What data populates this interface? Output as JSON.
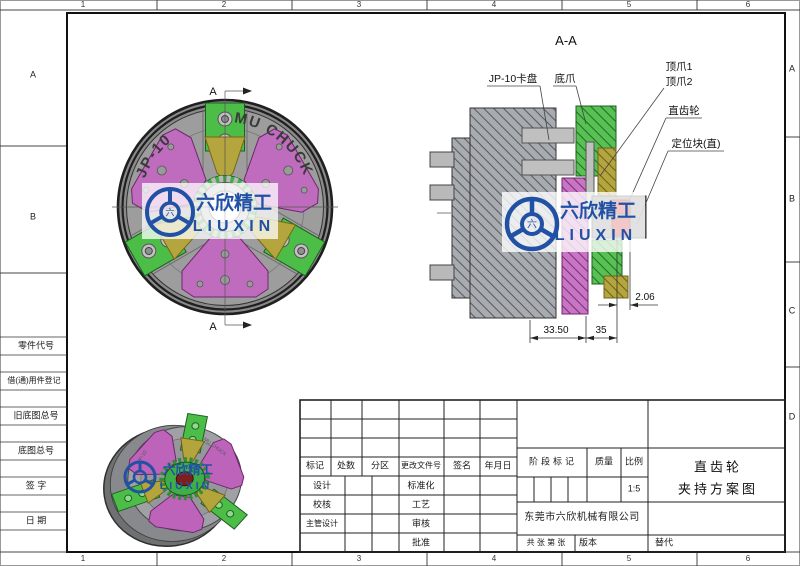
{
  "frame": {
    "cols": [
      "1",
      "2",
      "3",
      "4",
      "5",
      "6"
    ],
    "rows_left": [
      "A",
      "B"
    ],
    "rows_right": [
      "A",
      "B",
      "C",
      "D"
    ]
  },
  "left_panel": {
    "labels": [
      "零件代号",
      "借(通)用件登记",
      "旧底图总号",
      "底图总号",
      "签 字",
      "日 期"
    ]
  },
  "front_view": {
    "section_marker": "A",
    "brand_left": "JP-10",
    "brand_right": "MU CHUCK"
  },
  "section_view": {
    "title": "A-A",
    "callouts": {
      "chuck": "JP-10卡盘",
      "bottom_jaw": "底爪",
      "top_jaw1": "顶爪1",
      "top_jaw2": "顶爪2",
      "spur_gear": "直齿轮",
      "locating_block": "定位块(直)"
    },
    "dims": {
      "d1": "33.50",
      "d2": "35",
      "d3": "2.06"
    }
  },
  "watermark": {
    "cn": "六欣精工",
    "en": "LIUXIN",
    "hub": "六",
    "color": "#2151a5"
  },
  "title_block": {
    "rev_headers": [
      "标记",
      "处数",
      "分区",
      "更改文件号",
      "签名",
      "年月日"
    ],
    "sign_left": [
      "设计",
      "校核",
      "主管设计"
    ],
    "sign_right": [
      "标准化",
      "工艺",
      "审核",
      "批准"
    ],
    "stage": "阶段标记",
    "mass": "质量",
    "scale": "比例",
    "scale_value": "1:5",
    "company": "东莞市六欣机械有限公司",
    "sheets": "共 张 第 张",
    "version": "版本",
    "replace": "替代",
    "title1": "直齿轮",
    "title2": "夹持方案图"
  },
  "colors": {
    "jaw_green": "#4cbd47",
    "plate_purple": "#c06cbe",
    "wedge_yellow": "#b4a53e",
    "body_gray": "#9d9d9d",
    "logo_blue": "#2151a5",
    "block_red": "#c40000"
  }
}
